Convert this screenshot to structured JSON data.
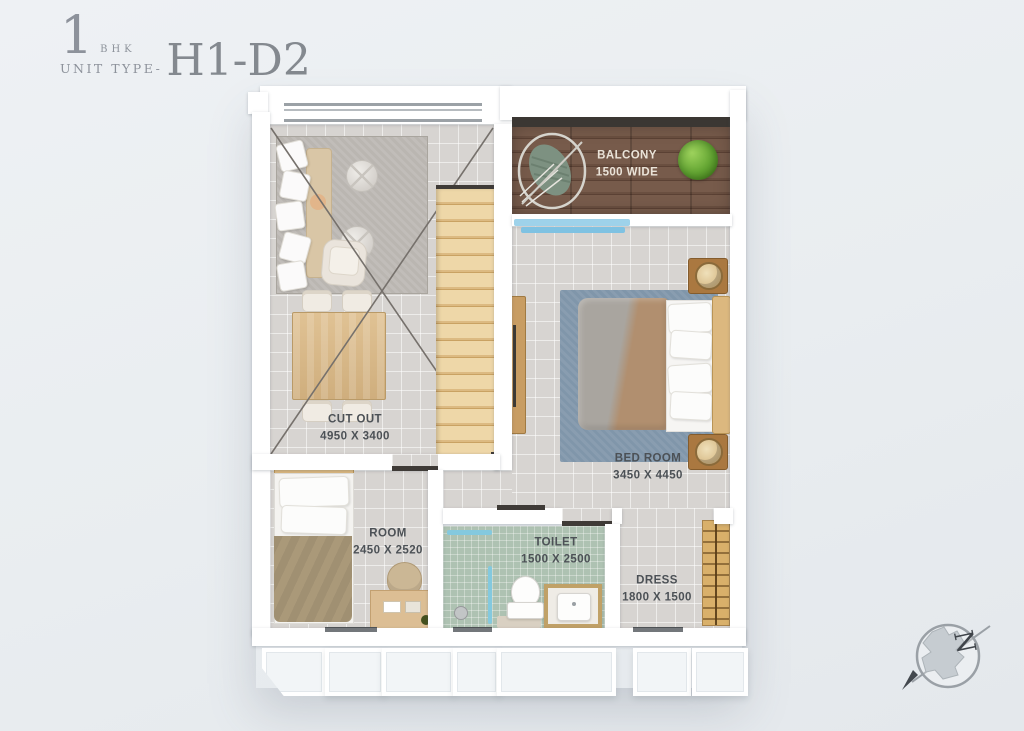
{
  "title": {
    "number": "1",
    "bhk": "BHK",
    "prefix": "UNIT TYPE-",
    "code": "H1-D2"
  },
  "rooms": {
    "cutout": {
      "name": "CUT OUT",
      "dims": "4950 X 3400"
    },
    "balcony": {
      "name": "BALCONY",
      "dims": "1500 WIDE"
    },
    "bedroom": {
      "name": "BED ROOM",
      "dims": "3450 X 4450"
    },
    "room": {
      "name": "ROOM",
      "dims": "2450 X 2520"
    },
    "toilet": {
      "name": "TOILET",
      "dims": "1500 X 2500"
    },
    "dress": {
      "name": "DRESS",
      "dims": "1800 X 1500"
    }
  },
  "compass": {
    "letter": "N"
  },
  "colors": {
    "background": "#e9edf0",
    "wall": "#ffffff",
    "tile": "#d7d4d1",
    "toilet_tile": "#aec2b2",
    "balcony_wood": "#6d5444",
    "railing": "#3b3733",
    "glass": "#84c9de",
    "label": "#4c5156",
    "label_light": "#eae3d8",
    "title": "#8d929b",
    "dark_mark": "#3f3b37"
  }
}
